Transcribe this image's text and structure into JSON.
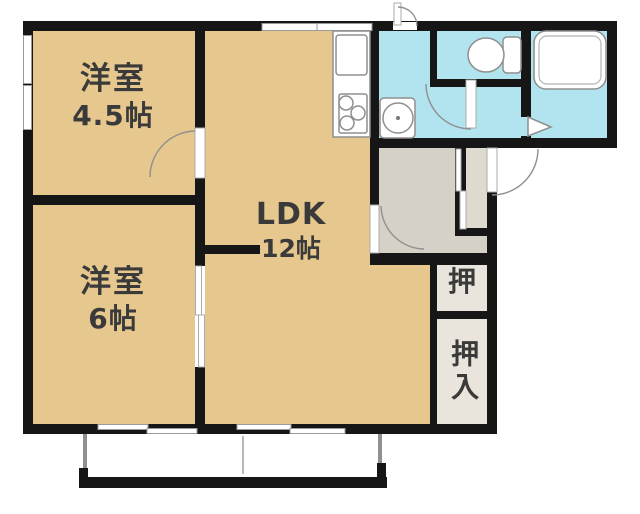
{
  "floor_plan": {
    "rooms": [
      {
        "name": "洋室",
        "size": "4.5帖"
      },
      {
        "name": "洋室",
        "size": "6帖"
      },
      {
        "name": "LDK",
        "size": "12帖"
      },
      {
        "name": "押"
      },
      {
        "name": "押入"
      }
    ],
    "fixture_icons": [
      "kitchen-sink-icon",
      "stove-burners-icon",
      "washing-machine-icon",
      "toilet-icon",
      "bathtub-icon",
      "bath-folding-door-icon"
    ],
    "colors": {
      "room_floor": "#e6c78d",
      "wet_area_floor": "#b2e4f0",
      "hallway_floor": "#d5d1c6",
      "closet_floor": "#e9e5dc",
      "wall": "#161616",
      "label_text": "#3a3a3a",
      "background": "#ffffff"
    }
  }
}
